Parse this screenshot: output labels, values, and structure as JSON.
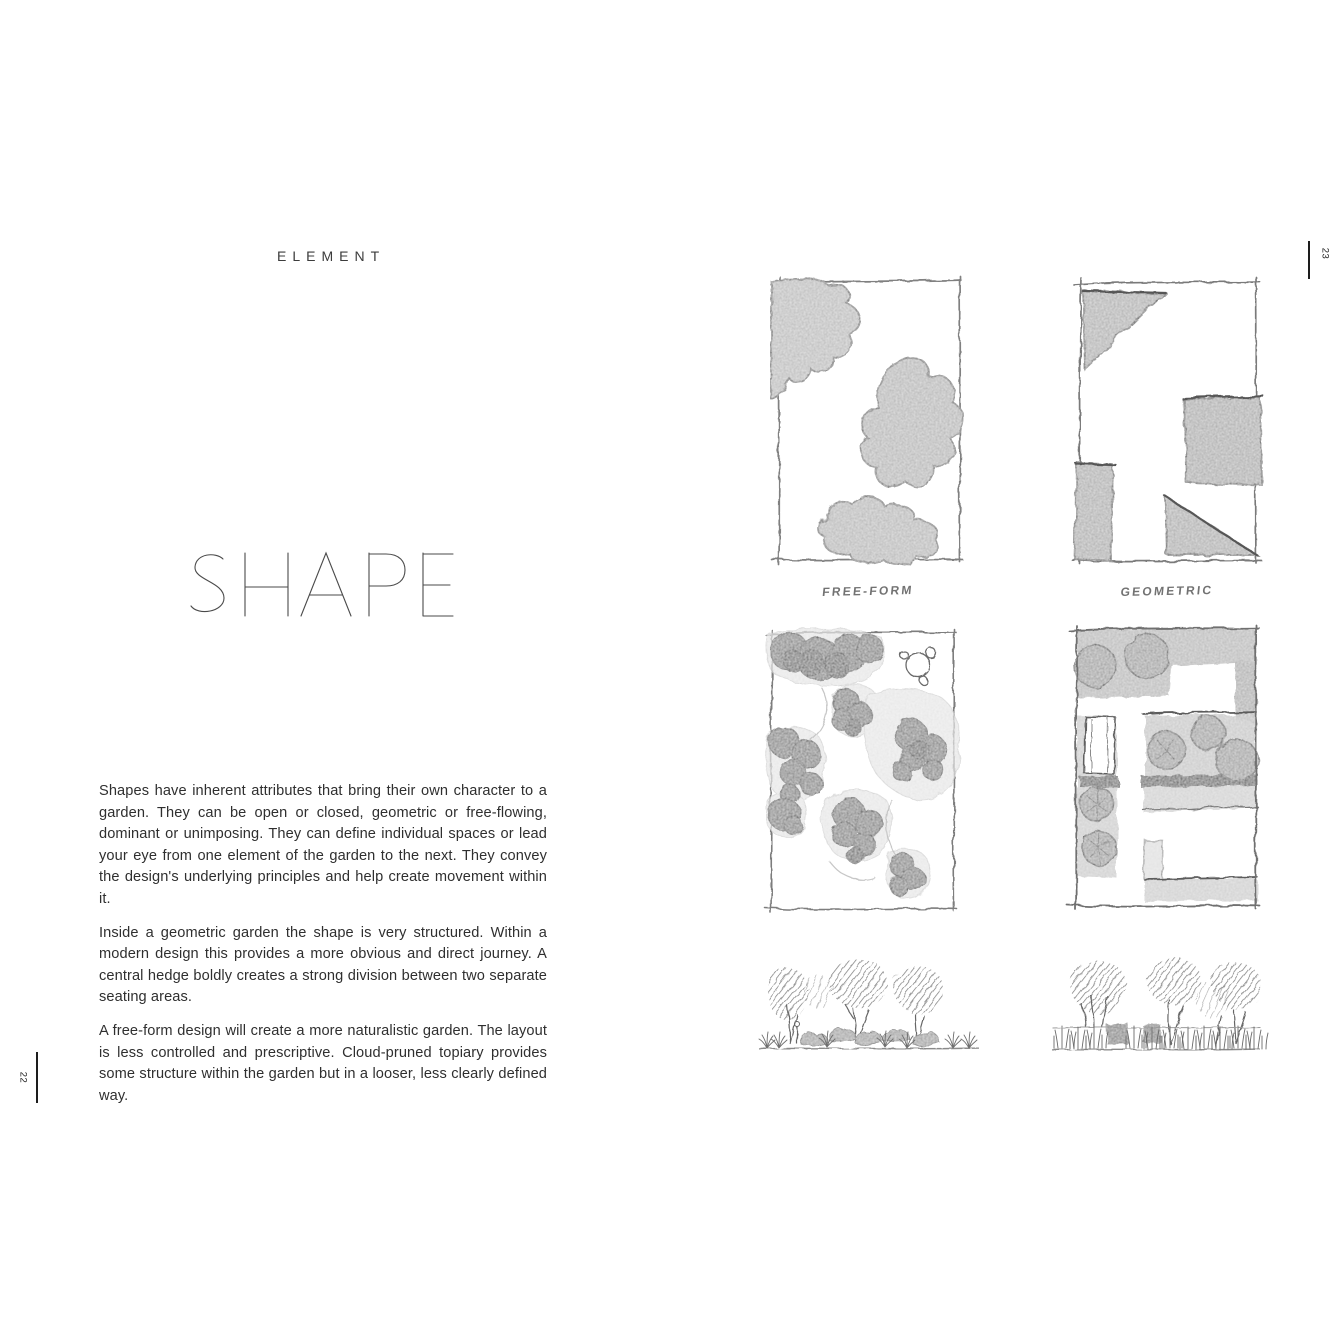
{
  "colors": {
    "paper": "#ffffff",
    "ink": "#2f2f2f",
    "pencil": "#7a7a7a"
  },
  "left_page": {
    "kicker": "ELEMENT",
    "title": "SHAPE",
    "paragraphs": [
      "Shapes have inherent attributes that bring their own character to a garden. They can be open or closed, geometric or free-flowing, dominant or unimposing. They can define individual spaces or lead your eye from one element of the garden to the next. They convey the design's underlying principles and help create movement within it.",
      "Inside a geometric garden the shape is very structured. Within a modern design this provides a more obvious and direct journey. A central hedge boldly creates a strong division between two separate seating areas.",
      "A free-form design will create a more naturalistic garden. The layout is less controlled and prescriptive. Cloud-pruned topiary provides some structure within the garden but in a looser, less clearly defined way."
    ],
    "folio": "22"
  },
  "right_page": {
    "folio": "23",
    "captions": {
      "free_form": "FREE-FORM",
      "geometric": "GEOMETRIC"
    }
  }
}
